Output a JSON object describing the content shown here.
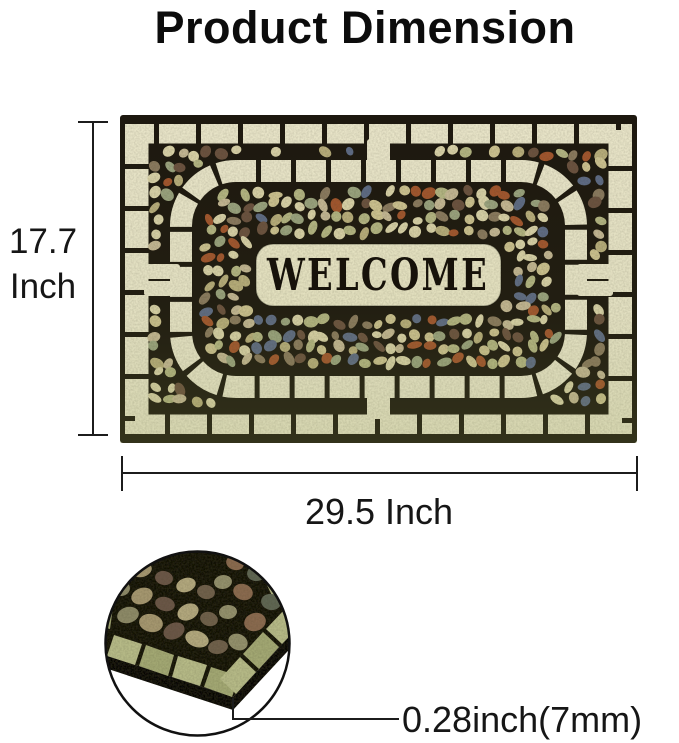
{
  "title": "Product Dimension",
  "dimensions": {
    "height_value": "17.7",
    "height_unit": "Inch",
    "width": "29.5 Inch",
    "thickness": "0.28inch(7mm)"
  },
  "mat": {
    "word": "WELCOME",
    "colors": {
      "grout": "#1d180f",
      "tile": "#e9e5c9",
      "plaque": "#e9e5c6",
      "ink": "#17120a",
      "pebbles": [
        "#d9d2a8",
        "#cdc291",
        "#b4b583",
        "#9aa37f",
        "#c4b794",
        "#8a795f",
        "#a2552e",
        "#5d6b85",
        "#6b5140",
        "#b8ad7c"
      ]
    }
  },
  "detail": {
    "colors": {
      "tile": "#b6ba87",
      "tile2": "#a3a873",
      "grout": "#17130d",
      "side": "#0d0a07",
      "stones": [
        "#8d8a68",
        "#a5976f",
        "#6b5747",
        "#b2a87e",
        "#70604b",
        "#93906c",
        "#8a6a50",
        "#5f6652"
      ]
    }
  },
  "annotation_color": "#1c1c1c"
}
